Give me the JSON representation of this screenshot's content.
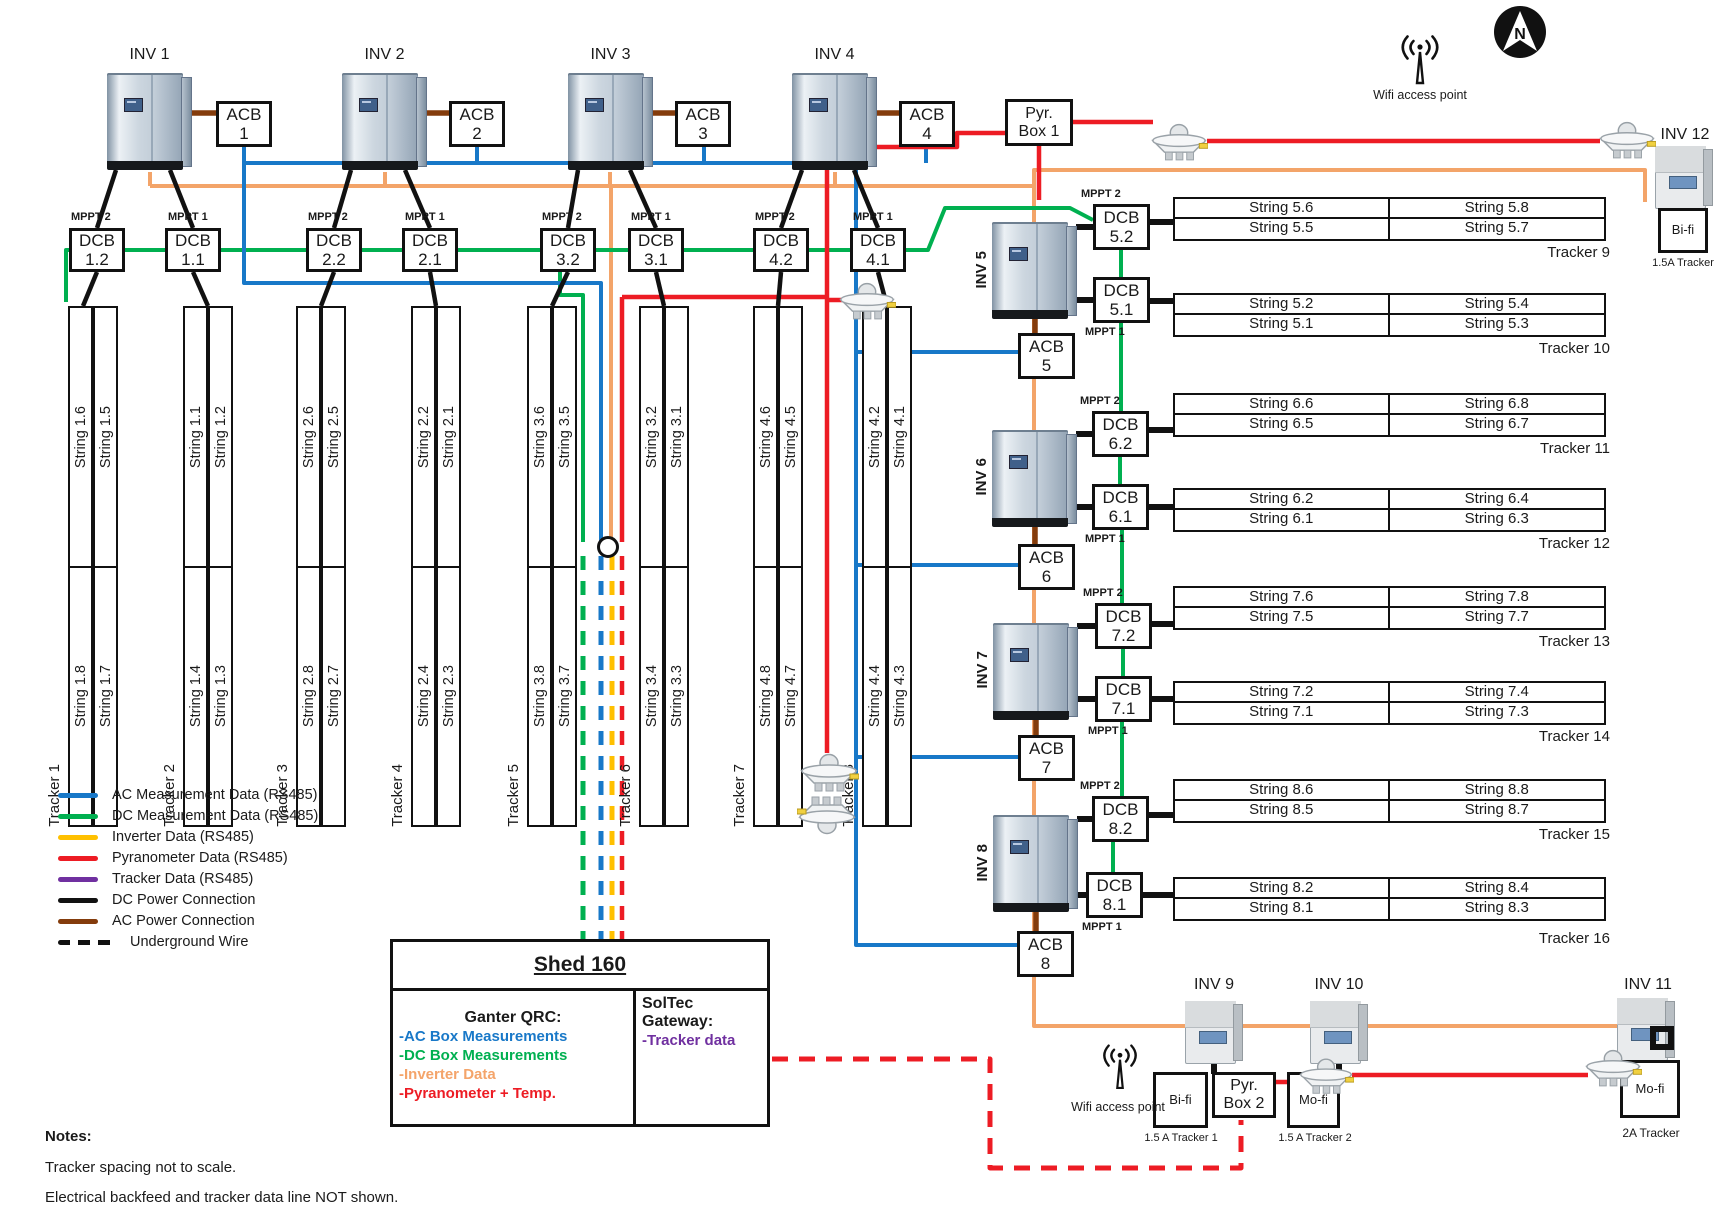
{
  "inverters": {
    "inv1": "INV 1",
    "inv2": "INV 2",
    "inv3": "INV 3",
    "inv4": "INV 4",
    "inv5": "INV 5",
    "inv6": "INV 6",
    "inv7": "INV 7",
    "inv8": "INV 8",
    "inv9": "INV 9",
    "inv10": "INV 10",
    "inv11": "INV 11",
    "inv12": "INV 12"
  },
  "boxes": {
    "acb_label": "ACB",
    "dcb_label": "DCB",
    "acb_numbers": [
      "1",
      "2",
      "3",
      "4",
      "5",
      "6",
      "7",
      "8"
    ],
    "dcb_numbers": [
      "1.2",
      "1.1",
      "2.2",
      "2.1",
      "3.2",
      "3.1",
      "4.2",
      "4.1",
      "5.2",
      "5.1",
      "6.2",
      "6.1",
      "7.2",
      "7.1",
      "8.2",
      "8.1"
    ]
  },
  "mppt": {
    "m1": "MPPT 1",
    "m2": "MPPT 2"
  },
  "left_trackers": [
    {
      "name": "Tracker 1",
      "top": [
        "String 1.6",
        "String 1.5"
      ],
      "bottom": [
        "String 1.8",
        "String 1.7"
      ]
    },
    {
      "name": "Tracker 2",
      "top": [
        "String 1.1",
        "String 1.2"
      ],
      "bottom": [
        "String 1.4",
        "String 1.3"
      ]
    },
    {
      "name": "Tracker 3",
      "top": [
        "String 2.6",
        "String 2.5"
      ],
      "bottom": [
        "String 2.8",
        "String 2.7"
      ]
    },
    {
      "name": "Tracker 4",
      "top": [
        "String 2.2",
        "String 2.1"
      ],
      "bottom": [
        "String 2.4",
        "String 2.3"
      ]
    },
    {
      "name": "Tracker 5",
      "top": [
        "String 3.6",
        "String 3.5"
      ],
      "bottom": [
        "String 3.8",
        "String 3.7"
      ]
    },
    {
      "name": "Tracker 6",
      "top": [
        "String 3.2",
        "String 3.1"
      ],
      "bottom": [
        "String 3.4",
        "String 3.3"
      ]
    },
    {
      "name": "Tracker 7",
      "top": [
        "String 4.6",
        "String 4.5"
      ],
      "bottom": [
        "String 4.8",
        "String 4.7"
      ]
    },
    {
      "name": "Tracker 8",
      "top": [
        "String 4.2",
        "String 4.1"
      ],
      "bottom": [
        "String 4.4",
        "String 4.3"
      ]
    }
  ],
  "right_trackers": [
    {
      "name": "Tracker 9",
      "r1": [
        "String 5.6",
        "String 5.8"
      ],
      "r2": [
        "String 5.5",
        "String 5.7"
      ]
    },
    {
      "name": "Tracker 10",
      "r1": [
        "String 5.2",
        "String 5.4"
      ],
      "r2": [
        "String 5.1",
        "String 5.3"
      ]
    },
    {
      "name": "Tracker 11",
      "r1": [
        "String 6.6",
        "String 6.8"
      ],
      "r2": [
        "String 6.5",
        "String 6.7"
      ]
    },
    {
      "name": "Tracker 12",
      "r1": [
        "String 6.2",
        "String 6.4"
      ],
      "r2": [
        "String 6.1",
        "String 6.3"
      ]
    },
    {
      "name": "Tracker 13",
      "r1": [
        "String 7.6",
        "String 7.8"
      ],
      "r2": [
        "String 7.5",
        "String 7.7"
      ]
    },
    {
      "name": "Tracker 14",
      "r1": [
        "String 7.2",
        "String 7.4"
      ],
      "r2": [
        "String 7.1",
        "String 7.3"
      ]
    },
    {
      "name": "Tracker 15",
      "r1": [
        "String 8.6",
        "String 8.8"
      ],
      "r2": [
        "String 8.5",
        "String 8.7"
      ]
    },
    {
      "name": "Tracker 16",
      "r1": [
        "String 8.2",
        "String 8.4"
      ],
      "r2": [
        "String 8.1",
        "String 8.3"
      ]
    }
  ],
  "legend": {
    "items": [
      {
        "label": "AC Measurement Data (RS485)",
        "color": "#1878c8",
        "dashed": false
      },
      {
        "label": "DC Measurement Data (RS485)",
        "color": "#00b050",
        "dashed": false
      },
      {
        "label": "Inverter Data (RS485)",
        "color": "#ffc000",
        "dashed": false
      },
      {
        "label": "Pyranometer Data (RS485)",
        "color": "#ed1c24",
        "dashed": false
      },
      {
        "label": "Tracker Data (RS485)",
        "color": "#7030a0",
        "dashed": false
      },
      {
        "label": "DC Power Connection",
        "color": "#111111",
        "dashed": false
      },
      {
        "label": "AC Power Connection",
        "color": "#843c0c",
        "dashed": false
      },
      {
        "label": "Underground Wire",
        "color": "#111111",
        "dashed": true
      }
    ]
  },
  "shed": {
    "title": "Shed 160",
    "ganter_title": "Ganter QRC:",
    "ganter_items": [
      {
        "text": "-AC Box Measurements",
        "color": "#1878c8"
      },
      {
        "text": "-DC Box Measurements",
        "color": "#00b050"
      },
      {
        "text": "-Inverter Data",
        "color": "#f4a46a"
      },
      {
        "text": "-Pyranometer + Temp.",
        "color": "#ed1c24"
      }
    ],
    "soltec_title": "SolTec Gateway:",
    "soltec_item": {
      "text": "-Tracker data",
      "color": "#7030a0"
    }
  },
  "notes": {
    "title": "Notes:",
    "lines": [
      "Tracker spacing not to scale.",
      "Electrical backfeed and tracker data line NOT shown."
    ]
  },
  "misc": {
    "pyr_box_1_l1": "Pyr.",
    "pyr_box_1_l2": "Box 1",
    "pyr_box_2_l1": "Pyr.",
    "pyr_box_2_l2": "Box 2",
    "wifi": "Wifi access point",
    "bifi": "Bi-fi",
    "mofi": "Mo-fi",
    "tracker_15a": "1.5A Tracker",
    "tracker_15a_1": "1.5 A Tracker 1",
    "tracker_15a_2": "1.5 A Tracker 2",
    "tracker_2a": "2A Tracker",
    "north": "N"
  }
}
